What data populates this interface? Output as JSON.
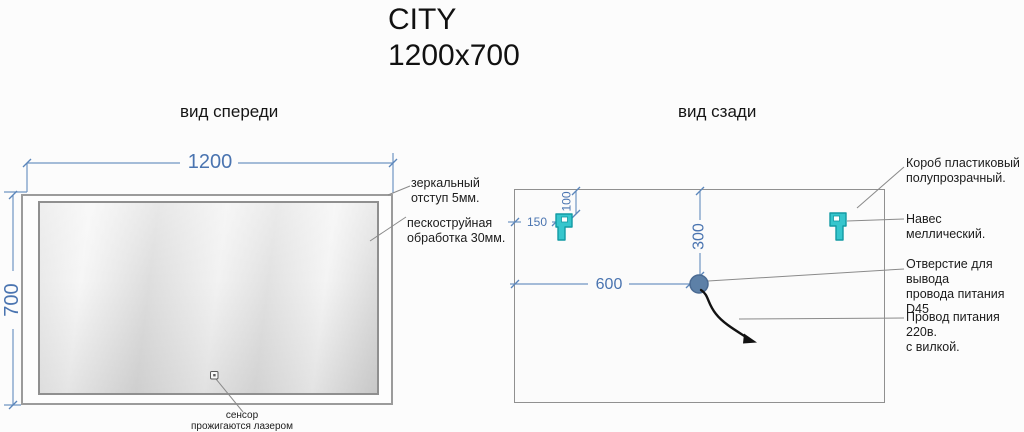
{
  "title": "CITY\n1200x700",
  "colors": {
    "dimension_blue_line": "#6f95c3",
    "dimension_blue_text": "#4a74b0",
    "hanger_teal": "#36c6cd",
    "hole_blue_gray": "#5d80a7",
    "leader_gray": "#8a8a8a",
    "frame_gray": "#9b9b9b",
    "text_black": "#1c1c1c"
  },
  "front": {
    "label": "вид спереди",
    "dims": {
      "width": "1200",
      "height": "700"
    },
    "notes": {
      "mirror_offset": "зеркальный\nотступ 5мм.",
      "sandblast": "пескоструйная\nобработка 30мм.",
      "sensor": "сенсор\nпрожигаются лазером"
    }
  },
  "back": {
    "label": "вид сзади",
    "dims": {
      "hanger_offset_x": "150",
      "hanger_offset_y": "100",
      "hole_offset_y": "300",
      "hole_offset_x": "600"
    },
    "notes": {
      "plastic_box": "Короб пластиковый\nполупрозрачный.",
      "hanger": "Навес меллический.",
      "hole": "Отверстие для вывода\nпровода питания D45",
      "cord": "Провод питания 220в.\nс вилкой."
    }
  },
  "icons": {
    "hanger": "hanger-bracket-icon",
    "hole": "cable-hole-icon",
    "cord": "power-cord-icon",
    "sensor": "sensor-icon"
  }
}
